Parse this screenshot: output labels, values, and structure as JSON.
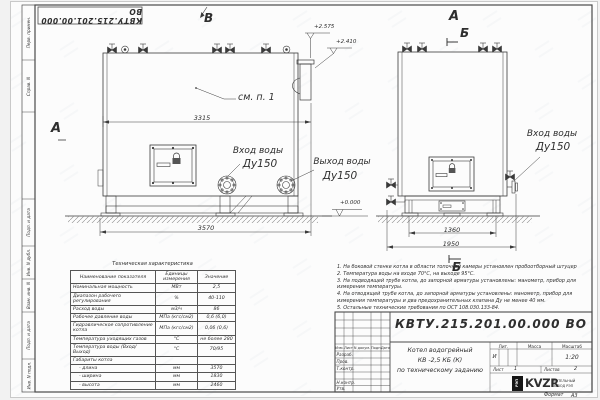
{
  "doc": {
    "number": "КВТУ.215.201.00.000 ВО",
    "format_label": "Формат",
    "format_value": "А3"
  },
  "frame": {
    "left_labels": [
      "Перв. примен.",
      "Справ. N",
      "Подп. и дата",
      "Инв. N дубл.",
      "Взам. инв. N",
      "Подп. и дата",
      "Инв. N подл."
    ]
  },
  "drawing": {
    "view_b": "В",
    "view_a_left": "А",
    "view_a_right": "А",
    "section_b_top": "Б",
    "section_b_bottom": "Б",
    "callout_see_item": "см. п. 1",
    "inlet_label": "Вход воды",
    "inlet_dn": "Ду150",
    "outlet_label": "Выход воды",
    "outlet_dn": "Ду150",
    "inlet2_label": "Вход воды",
    "inlet2_dn": "Ду150",
    "elev_top1": "+2.575",
    "elev_top2": "+2.410",
    "elev_zero": "+0.000",
    "dim_3315": "3315",
    "dim_3570": "3570",
    "dim_1360": "1360",
    "dim_1950": "1950"
  },
  "tech_table": {
    "title": "Техническая характеристика",
    "headers": [
      "Наименование показателя",
      "Единицы измерения",
      "Значение"
    ],
    "rows": [
      [
        "Номинальная мощность",
        "МВт",
        "2,5"
      ],
      [
        "Диапазон рабочего регулирования",
        "%",
        "40-110"
      ],
      [
        "Расход воды",
        "м3/ч",
        "86"
      ],
      [
        "Рабочее давление воды",
        "МПа (кгс/см2)",
        "0,6 (6,0)"
      ],
      [
        "Гидравлическое сопротивление котла",
        "МПа (кгс/см2)",
        "0,06 (0,6)"
      ],
      [
        "Температура уходящих газов",
        "°С",
        "не более 280"
      ],
      [
        "Температура воды (Вход/Выход)",
        "°С",
        "70/95"
      ],
      [
        "Габариты котла",
        "",
        ""
      ],
      [
        "- длина",
        "мм",
        "3570"
      ],
      [
        "- ширина",
        "мм",
        "1830"
      ],
      [
        "- высота",
        "мм",
        "2460"
      ]
    ]
  },
  "notes": {
    "n1": "1. На боковой стенке котла в области топочной камеры установлен пробоотборный штуцер",
    "n2": "2. Температура воды на входе 70°С, на выходе 95°С.",
    "n3": "3. На подводящей трубе котла, до запорной арматуры установлены: манометр, прибор для измерения температуры.",
    "n4": "4. На отводящей трубе котла, до запорной арматуры установлены: манометр, прибор для измерения температуры и два предохранительных клапана Ду не менее 40 мм.",
    "n5": "5. Остальные технические требования по ОСТ 108.030.133-84."
  },
  "title_block": {
    "doc_number": "КВТУ.215.201.00.000 ВО",
    "cols": [
      "Изм.",
      "Лист",
      "N докум.",
      "Подп.",
      "Дата"
    ],
    "signers": [
      "Разраб.",
      "Пров.",
      "Т.контр.",
      "Н.контр.",
      "Утв."
    ],
    "title_lines": [
      "Котел водогрейный",
      "КВ -2,5 КБ (К)",
      "по техническому заданию"
    ],
    "lit_label": "Лит.",
    "mass_label": "Масса",
    "scale_label": "Масштаб",
    "lit_value": "И",
    "scale_value": "1:20",
    "sheet_label": "Лист",
    "sheet_value": "1",
    "sheets_label": "Листов",
    "sheets_value": "2",
    "logo_box": "РЭП",
    "logo_main": "KVZR",
    "logo_sub1": "КОТЕЛЬНЫЙ",
    "logo_sub2": "ЗАВОД РЭП"
  }
}
